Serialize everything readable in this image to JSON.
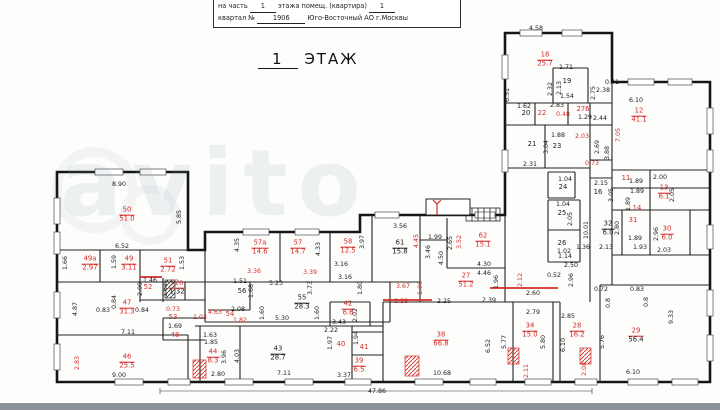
{
  "header": {
    "l1a": "на часть",
    "l1b": "1",
    "l1c": "этажа помещ. (квартира)",
    "l1d": "1",
    "l2a": "квартал №",
    "l2b": "1906",
    "l2c": "Юго-Восточный АО г.Москвы"
  },
  "title": {
    "number": "1",
    "word": "ЭТАЖ"
  },
  "watermark": "avito",
  "plan": {
    "overall_dim": "47.86",
    "rooms": [
      {
        "n": "50",
        "a": "51.0",
        "x": 127,
        "y": 215,
        "c": "r"
      },
      {
        "n": "49а",
        "a": "2.97",
        "x": 90,
        "y": 264,
        "c": "r"
      },
      {
        "n": "49",
        "a": "3.11",
        "x": 129,
        "y": 264,
        "c": "r"
      },
      {
        "n": "51",
        "a": "2.72",
        "x": 168,
        "y": 266,
        "c": "r"
      },
      {
        "n": "47",
        "a": "31.3",
        "x": 127,
        "y": 308,
        "c": "r"
      },
      {
        "n": "46",
        "a": "25.5",
        "x": 127,
        "y": 362,
        "c": "r"
      },
      {
        "n": "52",
        "x": 148,
        "y": 288,
        "c": "r"
      },
      {
        "n": "52а",
        "a": "1.32",
        "x": 177,
        "y": 288,
        "c": "rk"
      },
      {
        "n": "53",
        "x": 173,
        "y": 318,
        "c": "r"
      },
      {
        "n": "48",
        "x": 175,
        "y": 336,
        "c": "r"
      },
      {
        "n": "54",
        "x": 230,
        "y": 315,
        "c": "r"
      },
      {
        "n": "56",
        "x": 242,
        "y": 292,
        "c": "k"
      },
      {
        "n": "55",
        "a": "28.3",
        "x": 302,
        "y": 303,
        "c": "k"
      },
      {
        "n": "57а",
        "a": "14.6",
        "x": 260,
        "y": 248,
        "c": "r"
      },
      {
        "n": "57",
        "a": "14.7",
        "x": 298,
        "y": 248,
        "c": "r"
      },
      {
        "n": "58",
        "a": "12.5",
        "x": 348,
        "y": 247,
        "c": "r"
      },
      {
        "n": "61",
        "a": "15.8",
        "x": 400,
        "y": 248,
        "c": "k"
      },
      {
        "n": "62",
        "a": "15.1",
        "x": 483,
        "y": 241,
        "c": "r"
      },
      {
        "n": "27",
        "a": "51.2",
        "x": 466,
        "y": 281,
        "c": "r"
      },
      {
        "n": "42",
        "a": "6.6",
        "x": 348,
        "y": 309,
        "c": "r"
      },
      {
        "n": "40",
        "x": 341,
        "y": 345,
        "c": "r"
      },
      {
        "n": "41",
        "x": 364,
        "y": 348,
        "c": "r"
      },
      {
        "n": "39",
        "a": "6.5",
        "x": 359,
        "y": 366,
        "c": "r"
      },
      {
        "n": "44",
        "a": "8.3",
        "x": 213,
        "y": 357,
        "c": "r"
      },
      {
        "n": "43",
        "a": "28.7",
        "x": 278,
        "y": 354,
        "c": "k"
      },
      {
        "n": "38",
        "a": "66.8",
        "x": 441,
        "y": 340,
        "c": "r"
      },
      {
        "n": "34",
        "a": "15.0",
        "x": 530,
        "y": 331,
        "c": "r"
      },
      {
        "n": "28",
        "a": "16.2",
        "x": 577,
        "y": 331,
        "c": "r"
      },
      {
        "n": "29",
        "a": "56.4",
        "x": 636,
        "y": 336,
        "c": "rk"
      },
      {
        "n": "18",
        "a": "25.7",
        "x": 545,
        "y": 60,
        "c": "r"
      },
      {
        "n": "19",
        "x": 567,
        "y": 82,
        "c": "k"
      },
      {
        "n": "20",
        "x": 526,
        "y": 114,
        "c": "k"
      },
      {
        "n": "22",
        "x": 542,
        "y": 114,
        "c": "r"
      },
      {
        "n": "276",
        "x": 583,
        "y": 110,
        "c": "r"
      },
      {
        "n": "21",
        "x": 532,
        "y": 145,
        "c": "k"
      },
      {
        "n": "23",
        "x": 557,
        "y": 147,
        "c": "k"
      },
      {
        "n": "24",
        "x": 563,
        "y": 188,
        "c": "k"
      },
      {
        "n": "25",
        "x": 562,
        "y": 214,
        "c": "k"
      },
      {
        "n": "26",
        "x": 562,
        "y": 244,
        "c": "k"
      },
      {
        "n": "12",
        "a": "41.1",
        "x": 639,
        "y": 116,
        "c": "r"
      },
      {
        "n": "16",
        "x": 598,
        "y": 193,
        "c": "k"
      },
      {
        "n": "11",
        "x": 626,
        "y": 179,
        "c": "r"
      },
      {
        "n": "13",
        "a": "6.1",
        "x": 664,
        "y": 193,
        "c": "r"
      },
      {
        "n": "14",
        "x": 637,
        "y": 209,
        "c": "r"
      },
      {
        "n": "31",
        "x": 633,
        "y": 221,
        "c": "r"
      },
      {
        "n": "32",
        "a": "6.0",
        "x": 608,
        "y": 229,
        "c": "k"
      },
      {
        "n": "30",
        "a": "6.0",
        "x": 667,
        "y": 234,
        "c": "r"
      }
    ],
    "dims": [
      [
        "8.90",
        119,
        185,
        "k",
        0
      ],
      [
        "5.85",
        180,
        217,
        "k",
        1
      ],
      [
        "6.52",
        122,
        247,
        "k",
        0
      ],
      [
        "1.66",
        66,
        263,
        "k",
        1
      ],
      [
        "1.59",
        115,
        262,
        "k",
        1
      ],
      [
        "1.53",
        183,
        263,
        "k",
        1
      ],
      [
        "4.87",
        76,
        309,
        "k",
        1
      ],
      [
        "0.83",
        103,
        311,
        "k",
        0
      ],
      [
        "0.84",
        115,
        302,
        "k",
        1
      ],
      [
        "0.84",
        142,
        311,
        "k",
        0
      ],
      [
        "7.11",
        128,
        333,
        "k",
        0
      ],
      [
        "2.83",
        78,
        363,
        "r",
        1
      ],
      [
        "9.00",
        119,
        376,
        "k",
        0
      ],
      [
        "1.46",
        150,
        281,
        "k",
        0
      ],
      [
        "2.09",
        141,
        289,
        "k",
        1
      ],
      [
        "1.61",
        166,
        290,
        "k",
        1
      ],
      [
        "0.73",
        173,
        310,
        "r",
        0
      ],
      [
        "1.03",
        200,
        318,
        "r",
        0
      ],
      [
        "1.69",
        175,
        327,
        "k",
        0
      ],
      [
        "4.35",
        238,
        245,
        "k",
        1
      ],
      [
        "4.33",
        319,
        249,
        "k",
        1
      ],
      [
        "3.36",
        254,
        272,
        "r",
        0
      ],
      [
        "3.39",
        310,
        273,
        "r",
        0
      ],
      [
        "5.23",
        276,
        284,
        "k",
        0
      ],
      [
        "1.51",
        240,
        282,
        "k",
        0
      ],
      [
        "1.68",
        252,
        291,
        "k",
        1
      ],
      [
        "3.73",
        311,
        288,
        "k",
        1
      ],
      [
        "2.08",
        238,
        310,
        "k",
        0
      ],
      [
        "4.63",
        215,
        313,
        "r",
        0
      ],
      [
        "1.82",
        240,
        321,
        "r",
        0
      ],
      [
        "1.60",
        263,
        313,
        "k",
        1
      ],
      [
        "5.30",
        282,
        319,
        "k",
        0
      ],
      [
        "1.60",
        318,
        313,
        "k",
        1
      ],
      [
        "3.97",
        363,
        242,
        "k",
        1
      ],
      [
        "3.16",
        341,
        265,
        "k",
        0
      ],
      [
        "3.16",
        345,
        278,
        "k",
        0
      ],
      [
        "1.80",
        361,
        288,
        "k",
        1
      ],
      [
        "3.56",
        400,
        227,
        "k",
        0
      ],
      [
        "4.45",
        417,
        241,
        "r",
        1
      ],
      [
        "1.99",
        435,
        238,
        "k",
        0
      ],
      [
        "3.46",
        429,
        252,
        "k",
        1
      ],
      [
        "4.50",
        442,
        258,
        "k",
        1
      ],
      [
        "2.65",
        451,
        243,
        "k",
        1
      ],
      [
        "3.52",
        460,
        242,
        "r",
        1
      ],
      [
        "4.30",
        484,
        265,
        "k",
        0
      ],
      [
        "4.46",
        484,
        274,
        "k",
        0
      ],
      [
        "1.96",
        497,
        282,
        "k",
        1
      ],
      [
        "2.12",
        521,
        280,
        "r",
        1
      ],
      [
        "3.67",
        403,
        287,
        "r",
        0
      ],
      [
        "1.06",
        421,
        288,
        "r",
        1
      ],
      [
        "2.28",
        401,
        302,
        "r",
        0
      ],
      [
        "2.25",
        444,
        302,
        "k",
        0
      ],
      [
        "2.39",
        489,
        301,
        "k",
        0
      ],
      [
        "2.02",
        356,
        315,
        "k",
        1
      ],
      [
        "3.43",
        339,
        323,
        "k",
        0
      ],
      [
        "2.22",
        331,
        331,
        "k",
        0
      ],
      [
        "1.97",
        331,
        343,
        "k",
        1
      ],
      [
        "1.63",
        210,
        336,
        "k",
        0
      ],
      [
        "1.85",
        211,
        343,
        "k",
        0
      ],
      [
        "3.96",
        225,
        357,
        "k",
        1
      ],
      [
        "2.80",
        218,
        375,
        "k",
        0
      ],
      [
        "4.03",
        238,
        356,
        "k",
        1
      ],
      [
        "7.11",
        284,
        374,
        "k",
        0
      ],
      [
        "1.94",
        357,
        338,
        "k",
        1
      ],
      [
        "10.68",
        442,
        374,
        "k",
        0
      ],
      [
        "3.37",
        344,
        376,
        "k",
        0
      ],
      [
        "2.60",
        533,
        294,
        "k",
        0
      ],
      [
        "2.79",
        533,
        313,
        "k",
        0
      ],
      [
        "5.80",
        544,
        342,
        "k",
        1
      ],
      [
        "5.77",
        505,
        342,
        "k",
        1
      ],
      [
        "6.52",
        489,
        346,
        "k",
        1
      ],
      [
        "2.11",
        527,
        371,
        "r",
        1
      ],
      [
        "2.85",
        568,
        317,
        "k",
        0
      ],
      [
        "6.10",
        564,
        345,
        "k",
        1
      ],
      [
        "2.96",
        572,
        280,
        "k",
        1
      ],
      [
        "2.50",
        571,
        266,
        "k",
        0
      ],
      [
        "1.14",
        565,
        257,
        "k",
        0
      ],
      [
        "1.36",
        583,
        248,
        "k",
        0
      ],
      [
        "10.01",
        587,
        230,
        "k",
        1
      ],
      [
        "0.52",
        554,
        276,
        "k",
        0
      ],
      [
        "0.72",
        601,
        290,
        "k",
        0
      ],
      [
        "0.83",
        637,
        290,
        "k",
        0
      ],
      [
        "0.8",
        609,
        303,
        "k",
        1
      ],
      [
        "0.8",
        647,
        302,
        "k",
        1
      ],
      [
        "9.33",
        672,
        317,
        "k",
        1
      ],
      [
        "5.76",
        603,
        342,
        "k",
        1
      ],
      [
        "6.10",
        633,
        373,
        "k",
        0
      ],
      [
        "2.08",
        585,
        369,
        "r",
        1
      ],
      [
        "2.15",
        601,
        184,
        "k",
        0
      ],
      [
        "3.05",
        612,
        195,
        "k",
        1
      ],
      [
        "1.89",
        636,
        182,
        "k",
        0
      ],
      [
        "1.89",
        637,
        192,
        "k",
        0
      ],
      [
        "2.00",
        660,
        178,
        "k",
        0
      ],
      [
        "2.05",
        673,
        195,
        "k",
        1
      ],
      [
        "1.89",
        629,
        204,
        "k",
        1
      ],
      [
        "2.80",
        618,
        228,
        "k",
        1
      ],
      [
        "2.96",
        657,
        234,
        "k",
        1
      ],
      [
        "1.89",
        635,
        239,
        "k",
        0
      ],
      [
        "2.13",
        606,
        248,
        "k",
        0
      ],
      [
        "1.93",
        640,
        248,
        "k",
        0
      ],
      [
        "2.03",
        664,
        251,
        "k",
        0
      ],
      [
        "4.58",
        536,
        29,
        "k",
        0
      ],
      [
        "6.51",
        508,
        95,
        "k",
        1
      ],
      [
        "1.71",
        566,
        68,
        "k",
        0
      ],
      [
        "2.32",
        551,
        89,
        "k",
        1
      ],
      [
        "2.13",
        560,
        88,
        "k",
        1
      ],
      [
        "1.54",
        567,
        97,
        "k",
        0
      ],
      [
        "2.75",
        594,
        93,
        "k",
        1
      ],
      [
        "2.38",
        603,
        91,
        "k",
        0
      ],
      [
        "1.62",
        524,
        107,
        "k",
        0
      ],
      [
        "2.83",
        557,
        106,
        "k",
        0
      ],
      [
        "0.48",
        563,
        115,
        "r",
        0
      ],
      [
        "1.29",
        585,
        118,
        "k",
        0
      ],
      [
        "2.44",
        600,
        119,
        "k",
        0
      ],
      [
        "0.41",
        612,
        83,
        "k",
        0
      ],
      [
        "6.10",
        636,
        101,
        "k",
        0
      ],
      [
        "7.05",
        619,
        135,
        "r",
        1
      ],
      [
        "1.88",
        558,
        136,
        "k",
        0
      ],
      [
        "3.04",
        547,
        147,
        "k",
        1
      ],
      [
        "2.31",
        530,
        165,
        "k",
        0
      ],
      [
        "2.03",
        582,
        137,
        "r",
        0
      ],
      [
        "2.69",
        598,
        147,
        "k",
        1
      ],
      [
        "3.88",
        608,
        153,
        "k",
        1
      ],
      [
        "0.73",
        592,
        164,
        "r",
        0
      ],
      [
        "1.04",
        565,
        180,
        "k",
        0
      ],
      [
        "1.04",
        563,
        205,
        "k",
        0
      ],
      [
        "2.05",
        571,
        219,
        "k",
        1
      ],
      [
        "1.02",
        564,
        252,
        "k",
        0
      ],
      [
        "47.86",
        377,
        392,
        "k",
        0
      ]
    ]
  }
}
